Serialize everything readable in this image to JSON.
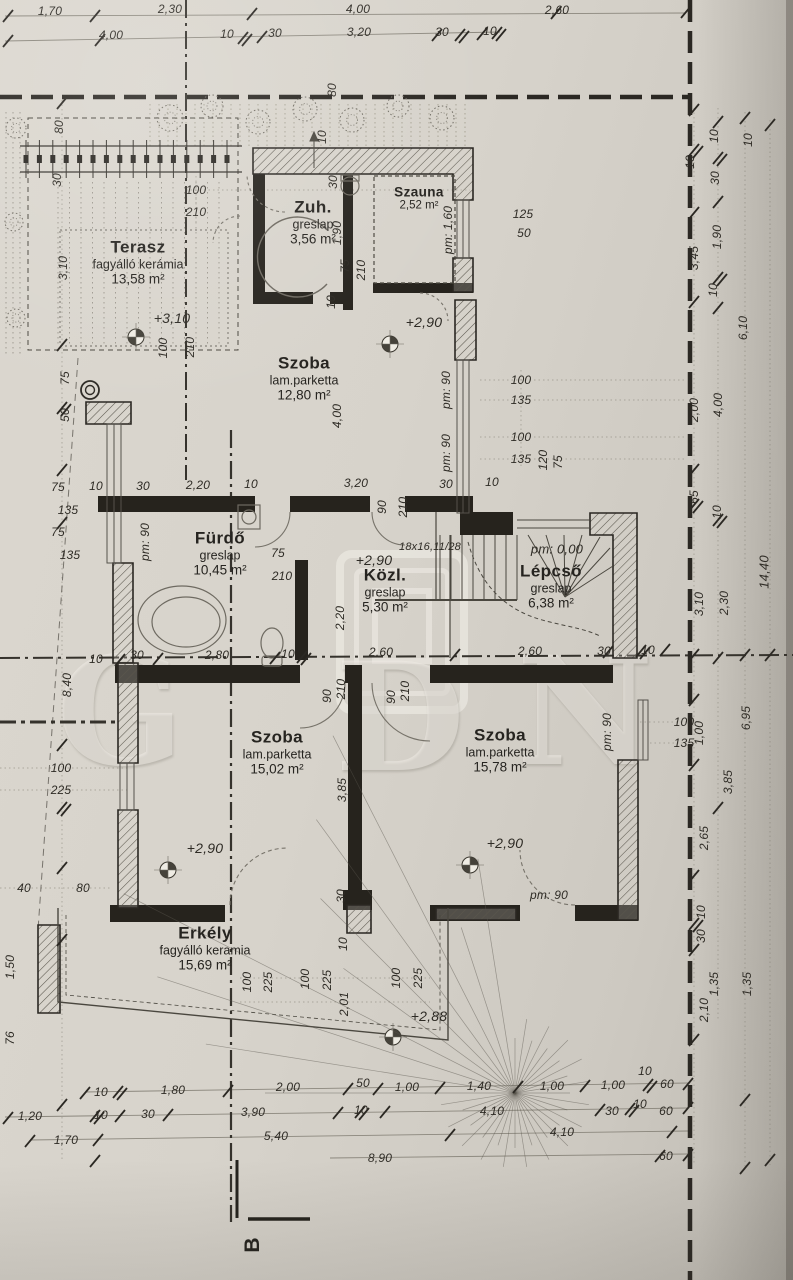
{
  "watermark": {
    "text": "GDN",
    "letters": [
      "G",
      "D",
      "N"
    ]
  },
  "section_marker": {
    "label": "B"
  },
  "rooms": [
    {
      "name": "Terasz",
      "finish": "fagyálló kerámia",
      "area": "13,58 m²",
      "x": 138,
      "y": 262
    },
    {
      "name": "Zuh.",
      "finish": "greslap",
      "area": "3,56 m²",
      "x": 313,
      "y": 222
    },
    {
      "name": "Szauna",
      "finish": "",
      "area": "2,52 m²",
      "x": 419,
      "y": 198,
      "small": true
    },
    {
      "name": "Szoba",
      "finish": "lam.parketta",
      "area": "12,80 m²",
      "x": 304,
      "y": 378
    },
    {
      "name": "Fürdő",
      "finish": "greslap",
      "area": "10,45 m²",
      "x": 220,
      "y": 553
    },
    {
      "name": "Közl.",
      "finish": "greslap",
      "area": "5,30 m²",
      "x": 385,
      "y": 590
    },
    {
      "name": "Lépcső",
      "finish": "greslap",
      "area": "6,38 m²",
      "x": 551,
      "y": 586
    },
    {
      "name": "Szoba",
      "finish": "lam.parketta",
      "area": "15,02 m²",
      "x": 277,
      "y": 752
    },
    {
      "name": "Szoba",
      "finish": "lam.parketta",
      "area": "15,78 m²",
      "x": 500,
      "y": 750
    },
    {
      "name": "Erkély",
      "finish": "fagyálló keramia",
      "area": "15,69 m²",
      "x": 205,
      "y": 948
    }
  ],
  "labels": [
    {
      "t": "1,70",
      "x": 50,
      "y": 11
    },
    {
      "t": "2,30",
      "x": 170,
      "y": 9
    },
    {
      "t": "4,00",
      "x": 358,
      "y": 9
    },
    {
      "t": "2,60",
      "x": 557,
      "y": 10
    },
    {
      "t": "4,00",
      "x": 111,
      "y": 35
    },
    {
      "t": "10",
      "x": 227,
      "y": 34
    },
    {
      "t": "30",
      "x": 275,
      "y": 33
    },
    {
      "t": "3,20",
      "x": 359,
      "y": 32
    },
    {
      "t": "30",
      "x": 442,
      "y": 32
    },
    {
      "t": "10",
      "x": 490,
      "y": 31
    },
    {
      "t": "80",
      "x": 332,
      "y": 90,
      "r": -90
    },
    {
      "t": "10",
      "x": 322,
      "y": 137,
      "r": -90
    },
    {
      "t": "80",
      "x": 59,
      "y": 127,
      "r": -90
    },
    {
      "t": "30",
      "x": 57,
      "y": 180,
      "r": -90
    },
    {
      "t": "3,10",
      "x": 63,
      "y": 268,
      "r": -90
    },
    {
      "t": "75",
      "x": 65,
      "y": 378,
      "r": -90
    },
    {
      "t": "50",
      "x": 65,
      "y": 415,
      "r": -90
    },
    {
      "t": "100",
      "x": 196,
      "y": 190
    },
    {
      "t": "210",
      "x": 196,
      "y": 212
    },
    {
      "t": "100",
      "x": 163,
      "y": 348,
      "r": -90
    },
    {
      "t": "210",
      "x": 190,
      "y": 347,
      "r": -90
    },
    {
      "t": "+3,10",
      "x": 172,
      "y": 318,
      "s": 14,
      "n": "level-label"
    },
    {
      "t": "30",
      "x": 333,
      "y": 182,
      "r": -90
    },
    {
      "t": "1,90",
      "x": 337,
      "y": 233,
      "r": -90
    },
    {
      "t": "75",
      "x": 345,
      "y": 266,
      "r": -90
    },
    {
      "t": "210",
      "x": 361,
      "y": 270,
      "r": -90
    },
    {
      "t": "10",
      "x": 331,
      "y": 302,
      "r": -90
    },
    {
      "t": "125",
      "x": 523,
      "y": 214
    },
    {
      "t": "50",
      "x": 524,
      "y": 233
    },
    {
      "t": "pm: 1,60",
      "x": 448,
      "y": 230,
      "r": -90,
      "n": "pm-label"
    },
    {
      "t": "10",
      "x": 690,
      "y": 162,
      "r": -90
    },
    {
      "t": "3,45",
      "x": 694,
      "y": 258,
      "r": -90
    },
    {
      "t": "2,00",
      "x": 694,
      "y": 410,
      "r": -90
    },
    {
      "t": "10",
      "x": 714,
      "y": 136,
      "r": -90
    },
    {
      "t": "30",
      "x": 715,
      "y": 178,
      "r": -90
    },
    {
      "t": "1,90",
      "x": 717,
      "y": 237,
      "r": -90
    },
    {
      "t": "10",
      "x": 713,
      "y": 290,
      "r": -90
    },
    {
      "t": "4,00",
      "x": 718,
      "y": 405,
      "r": -90
    },
    {
      "t": "10",
      "x": 748,
      "y": 140,
      "r": -90
    },
    {
      "t": "6,10",
      "x": 743,
      "y": 328,
      "r": -90
    },
    {
      "t": "+2,90",
      "x": 424,
      "y": 322,
      "s": 14,
      "n": "level-label"
    },
    {
      "t": "4,00",
      "x": 337,
      "y": 416,
      "r": -90
    },
    {
      "t": "pm: 90",
      "x": 446,
      "y": 390,
      "r": -90,
      "n": "pm-label"
    },
    {
      "t": "pm: 90",
      "x": 446,
      "y": 453,
      "r": -90,
      "n": "pm-label"
    },
    {
      "t": "100",
      "x": 521,
      "y": 380
    },
    {
      "t": "135",
      "x": 521,
      "y": 400
    },
    {
      "t": "100",
      "x": 521,
      "y": 437
    },
    {
      "t": "135",
      "x": 521,
      "y": 459
    },
    {
      "t": "120",
      "x": 543,
      "y": 460,
      "r": -90
    },
    {
      "t": "75",
      "x": 558,
      "y": 462,
      "r": -90
    },
    {
      "t": "3,20",
      "x": 356,
      "y": 483
    },
    {
      "t": "30",
      "x": 446,
      "y": 484
    },
    {
      "t": "10",
      "x": 492,
      "y": 482
    },
    {
      "t": "10",
      "x": 96,
      "y": 486
    },
    {
      "t": "30",
      "x": 143,
      "y": 486
    },
    {
      "t": "2,20",
      "x": 198,
      "y": 485
    },
    {
      "t": "10",
      "x": 251,
      "y": 484
    },
    {
      "t": "75",
      "x": 58,
      "y": 487
    },
    {
      "t": "135",
      "x": 68,
      "y": 510
    },
    {
      "t": "75",
      "x": 58,
      "y": 532
    },
    {
      "t": "135",
      "x": 70,
      "y": 555
    },
    {
      "t": "pm: 90",
      "x": 145,
      "y": 542,
      "r": -90,
      "n": "pm-label"
    },
    {
      "t": "75",
      "x": 278,
      "y": 553
    },
    {
      "t": "210",
      "x": 282,
      "y": 576
    },
    {
      "t": "90",
      "x": 382,
      "y": 507,
      "r": -90
    },
    {
      "t": "210",
      "x": 403,
      "y": 507,
      "r": -90
    },
    {
      "t": "18x16,11/28",
      "x": 430,
      "y": 547,
      "s": 11,
      "n": "stair-spec-label"
    },
    {
      "t": "pm: 0,00",
      "x": 557,
      "y": 549,
      "s": 13,
      "n": "pm-label"
    },
    {
      "t": "+2,90",
      "x": 374,
      "y": 560,
      "s": 14,
      "n": "level-label"
    },
    {
      "t": "2,20",
      "x": 340,
      "y": 618,
      "r": -90
    },
    {
      "t": "30",
      "x": 137,
      "y": 655
    },
    {
      "t": "2,80",
      "x": 217,
      "y": 655
    },
    {
      "t": "10",
      "x": 288,
      "y": 654
    },
    {
      "t": "2,60",
      "x": 381,
      "y": 652
    },
    {
      "t": "2,60",
      "x": 530,
      "y": 651
    },
    {
      "t": "30",
      "x": 604,
      "y": 651
    },
    {
      "t": "10",
      "x": 648,
      "y": 650
    },
    {
      "t": "90",
      "x": 327,
      "y": 696,
      "r": -90
    },
    {
      "t": "210",
      "x": 341,
      "y": 689,
      "r": -90
    },
    {
      "t": "90",
      "x": 391,
      "y": 697,
      "r": -90
    },
    {
      "t": "210",
      "x": 405,
      "y": 691,
      "r": -90
    },
    {
      "t": "65",
      "x": 694,
      "y": 497,
      "r": -90
    },
    {
      "t": "10",
      "x": 717,
      "y": 512,
      "r": -90
    },
    {
      "t": "3,10",
      "x": 699,
      "y": 604,
      "r": -90
    },
    {
      "t": "2,30",
      "x": 724,
      "y": 603,
      "r": -90
    },
    {
      "t": "14,40",
      "x": 764,
      "y": 572,
      "r": -90,
      "s": 13
    },
    {
      "t": "100",
      "x": 684,
      "y": 722
    },
    {
      "t": "135",
      "x": 684,
      "y": 743
    },
    {
      "t": "1,00",
      "x": 699,
      "y": 733,
      "r": -90
    },
    {
      "t": "6,95",
      "x": 746,
      "y": 718,
      "r": -90
    },
    {
      "t": "3,85",
      "x": 728,
      "y": 782,
      "r": -90
    },
    {
      "t": "2,65",
      "x": 704,
      "y": 838,
      "r": -90
    },
    {
      "t": "8,40",
      "x": 67,
      "y": 685,
      "r": -90
    },
    {
      "t": "10",
      "x": 96,
      "y": 659
    },
    {
      "t": "100",
      "x": 61,
      "y": 768
    },
    {
      "t": "225",
      "x": 61,
      "y": 790
    },
    {
      "t": "40",
      "x": 24,
      "y": 888
    },
    {
      "t": "80",
      "x": 83,
      "y": 888
    },
    {
      "t": "1,50",
      "x": 10,
      "y": 967,
      "r": -90
    },
    {
      "t": "76",
      "x": 10,
      "y": 1038,
      "r": -90
    },
    {
      "t": "3,85",
      "x": 342,
      "y": 790,
      "r": -90
    },
    {
      "t": "30",
      "x": 341,
      "y": 896,
      "r": -90
    },
    {
      "t": "+2,90",
      "x": 205,
      "y": 848,
      "s": 14,
      "n": "level-label"
    },
    {
      "t": "+2,90",
      "x": 505,
      "y": 843,
      "s": 14,
      "n": "level-label"
    },
    {
      "t": "pm: 90",
      "x": 607,
      "y": 732,
      "r": -90,
      "n": "pm-label"
    },
    {
      "t": "pm: 90",
      "x": 549,
      "y": 895,
      "n": "pm-label"
    },
    {
      "t": "10",
      "x": 701,
      "y": 912,
      "r": -90
    },
    {
      "t": "30",
      "x": 701,
      "y": 936,
      "r": -90
    },
    {
      "t": "1,35",
      "x": 714,
      "y": 984,
      "r": -90
    },
    {
      "t": "2,10",
      "x": 704,
      "y": 1010,
      "r": -90
    },
    {
      "t": "1,35",
      "x": 747,
      "y": 984,
      "r": -90
    },
    {
      "t": "10",
      "x": 343,
      "y": 944,
      "r": -90
    },
    {
      "t": "100",
      "x": 247,
      "y": 982,
      "r": -90
    },
    {
      "t": "225",
      "x": 268,
      "y": 982,
      "r": -90
    },
    {
      "t": "100",
      "x": 305,
      "y": 979,
      "r": -90
    },
    {
      "t": "225",
      "x": 327,
      "y": 980,
      "r": -90
    },
    {
      "t": "2,01",
      "x": 344,
      "y": 1004,
      "r": -90
    },
    {
      "t": "100",
      "x": 396,
      "y": 978,
      "r": -90
    },
    {
      "t": "225",
      "x": 418,
      "y": 978,
      "r": -90
    },
    {
      "t": "+2,88",
      "x": 429,
      "y": 1016,
      "s": 14,
      "n": "level-label"
    },
    {
      "t": "10",
      "x": 101,
      "y": 1092
    },
    {
      "t": "1,80",
      "x": 173,
      "y": 1090
    },
    {
      "t": "2,00",
      "x": 288,
      "y": 1087
    },
    {
      "t": "50",
      "x": 363,
      "y": 1083
    },
    {
      "t": "1,00",
      "x": 407,
      "y": 1087
    },
    {
      "t": "1,40",
      "x": 479,
      "y": 1086
    },
    {
      "t": "1,00",
      "x": 552,
      "y": 1086
    },
    {
      "t": "1,00",
      "x": 613,
      "y": 1085
    },
    {
      "t": "10",
      "x": 645,
      "y": 1071
    },
    {
      "t": "60",
      "x": 667,
      "y": 1084
    },
    {
      "t": "1,20",
      "x": 30,
      "y": 1116
    },
    {
      "t": "10",
      "x": 101,
      "y": 1115
    },
    {
      "t": "30",
      "x": 148,
      "y": 1114
    },
    {
      "t": "3,90",
      "x": 253,
      "y": 1112
    },
    {
      "t": "10",
      "x": 361,
      "y": 1110
    },
    {
      "t": "4,10",
      "x": 492,
      "y": 1111
    },
    {
      "t": "30",
      "x": 612,
      "y": 1111
    },
    {
      "t": "10",
      "x": 640,
      "y": 1104
    },
    {
      "t": "60",
      "x": 666,
      "y": 1111
    },
    {
      "t": "1,70",
      "x": 66,
      "y": 1140
    },
    {
      "t": "5,40",
      "x": 276,
      "y": 1136
    },
    {
      "t": "4,10",
      "x": 562,
      "y": 1132
    },
    {
      "t": "8,90",
      "x": 380,
      "y": 1158
    },
    {
      "t": "60",
      "x": 666,
      "y": 1156
    }
  ]
}
